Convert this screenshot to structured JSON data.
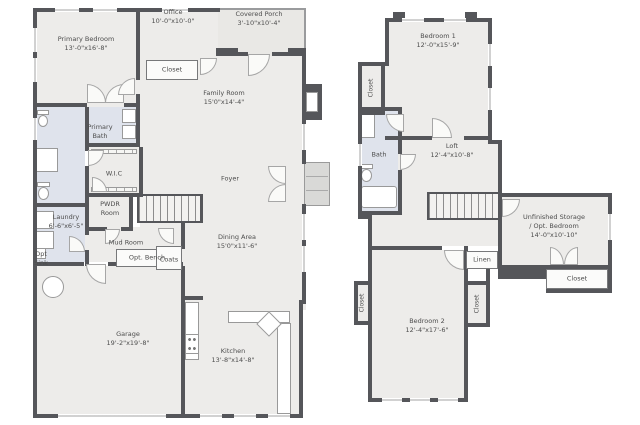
{
  "colors": {
    "wall": "#55565a",
    "room": "#edecea",
    "bath": "#dfe3ec",
    "porch": "#e9e8e5",
    "text": "#4d4d4d"
  },
  "floor1": {
    "primary_bedroom": {
      "name": "Primary Bedroom",
      "dims": "13'-0\"x16'-8\""
    },
    "office": {
      "name": "Office",
      "dims": "10'-0\"x10'-0\""
    },
    "covered_porch": {
      "name": "Covered Porch",
      "dims": "3'-10\"x10'-4\""
    },
    "closet": {
      "name": "Closet"
    },
    "family_room": {
      "name": "Family Room",
      "dims": "15'0\"x14'-4\""
    },
    "primary_bath": {
      "name": "Primary Bath"
    },
    "wic": {
      "name": "W.I.C"
    },
    "foyer": {
      "name": "Foyer"
    },
    "pwdr_room": {
      "name": "PWDR Room"
    },
    "laundry": {
      "name": "Laundry",
      "dims": "6'-6\"x6'-5\""
    },
    "opt_sink": {
      "name": "Opt Sink"
    },
    "mud_room": {
      "name": "Mud Room"
    },
    "opt_bench": {
      "name": "Opt. Bench"
    },
    "coats": {
      "name": "Coats"
    },
    "dining_area": {
      "name": "Dining Area",
      "dims": "15'0\"x11'-6\""
    },
    "garage": {
      "name": "Garage",
      "dims": "19'-2\"x19'-8\""
    },
    "kitchen": {
      "name": "Kitchen",
      "dims": "13'-8\"x14'-8\""
    }
  },
  "floor2": {
    "bedroom1": {
      "name": "Bedroom 1",
      "dims": "12'-0\"x15'-9\""
    },
    "closet_b1": {
      "name": "Closet"
    },
    "bath": {
      "name": "Bath"
    },
    "loft": {
      "name": "Loft",
      "dims": "12'-4\"x10'-8\""
    },
    "storage": {
      "name": "Unfinished Storage",
      "name2": "/ Opt. Bedroom",
      "dims": "14'-0\"x10'-10\""
    },
    "closet_storage": {
      "name": "Closet"
    },
    "linen": {
      "name": "Linen"
    },
    "bedroom2": {
      "name": "Bedroom 2",
      "dims": "12'-4\"x17'-6\""
    },
    "closet_left": {
      "name": "Closet"
    },
    "closet_right": {
      "name": "Closet"
    }
  }
}
